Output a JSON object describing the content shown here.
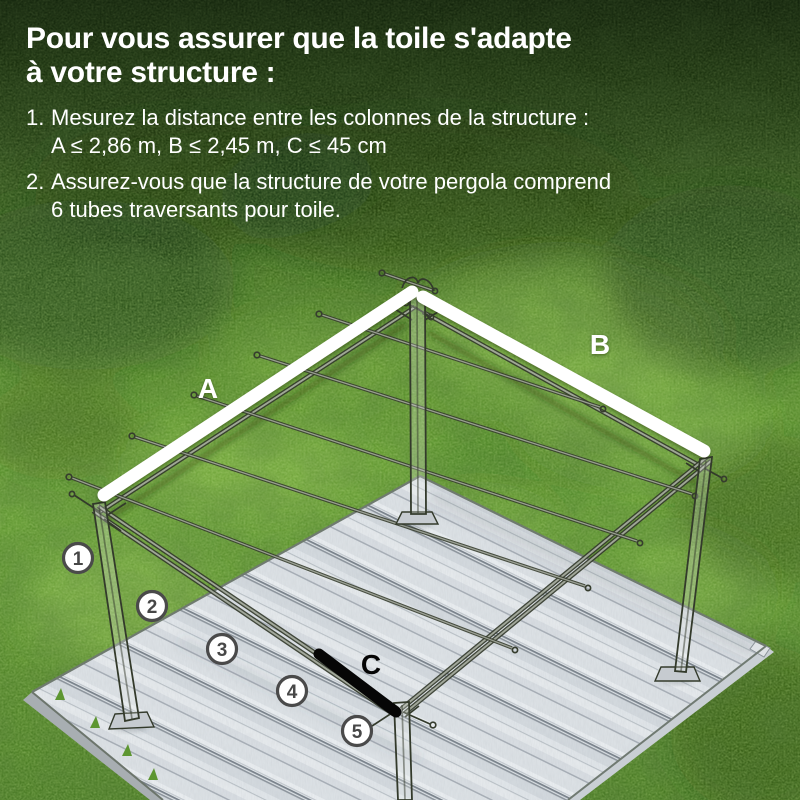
{
  "header": {
    "title_line1": "Pour vous assurer que la toile s'adapte",
    "title_line2": "à votre structure :",
    "items": [
      {
        "number": "1.",
        "line1": "Mesurez la distance entre les colonnes de la structure :",
        "line2": "A ≤ 2,86 m, B ≤ 2,45 m, C ≤ 45 cm"
      },
      {
        "number": "2.",
        "line1": "Assurez-vous que la structure de votre pergola comprend",
        "line2": "6 tubes traversants pour toile."
      }
    ]
  },
  "diagram": {
    "dimension_labels": {
      "a": "A",
      "b": "B",
      "c": "C"
    },
    "tube_markers": [
      "1",
      "2",
      "3",
      "4",
      "5"
    ],
    "colors": {
      "highlight_beam": "#ffffff",
      "measure_bar": "#000000",
      "marker_stroke": "#4a4a4a",
      "grass_dark": "#1c3311",
      "grass_light": "#649b33",
      "deck": "#dde2e6"
    }
  }
}
